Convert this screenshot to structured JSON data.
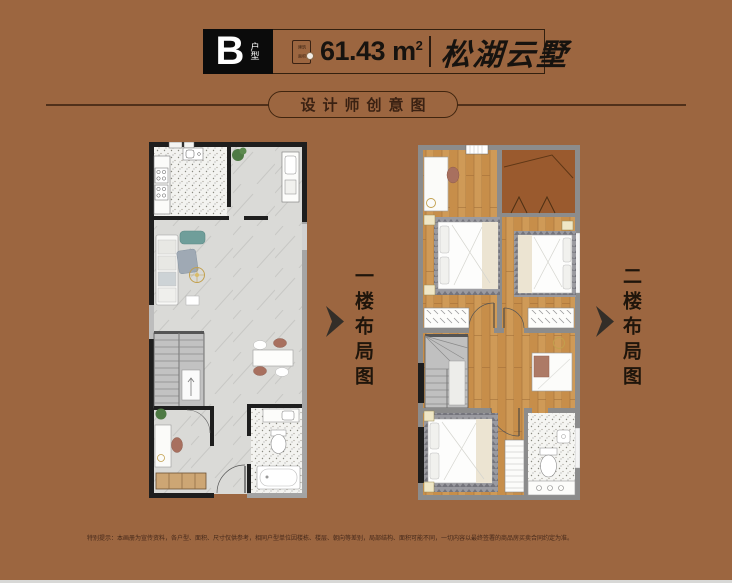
{
  "header": {
    "unit_letter": "B",
    "unit_label": "户型",
    "seal_top": "建筑",
    "seal_bottom": "面积",
    "area_value": "61.43 m",
    "area_exponent": "2",
    "project_name": "松湖云墅"
  },
  "section": {
    "title": "设计师创意图"
  },
  "plans": {
    "floor1_label": "一楼布局图",
    "floor2_label": "二楼布局图"
  },
  "footer": {
    "disclaimer": "特别提示：本画册为宣传资料，各户型、面积、尺寸仅供参考，相同户型单位因楼栋、楼层、朝向等差别，局部结构、面积可能不同，一切内容以最终签署的商品房买卖合同约定为准。"
  },
  "colors": {
    "background": "#9c6640",
    "ink": "#3a2213",
    "wall_dark": "#1e1e1e",
    "wall_grey": "#8c8c8c",
    "wood_floor": "#c78e4a",
    "balcony_floor": "#9a5a2e"
  }
}
